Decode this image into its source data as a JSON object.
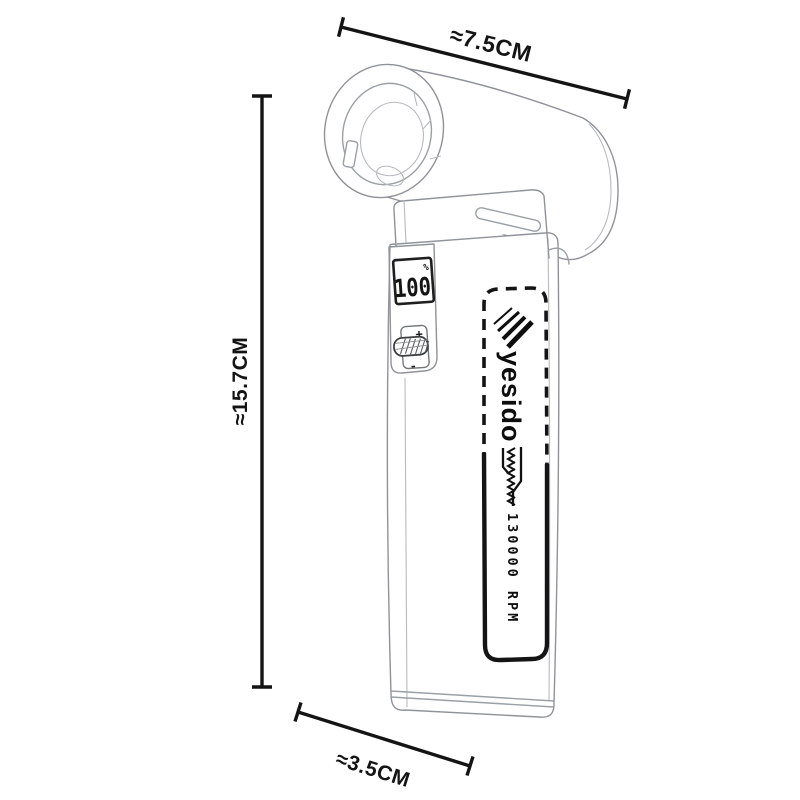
{
  "dimensions": {
    "width": {
      "label": "≈7.5CM"
    },
    "height": {
      "label": "≈15.7CM"
    },
    "depth": {
      "label": "≈3.5CM"
    }
  },
  "fan": {
    "display": {
      "value": "100",
      "unit": "%"
    },
    "controls": {
      "plus": "+",
      "minus": "-"
    },
    "branding": {
      "logo_text": "yesido",
      "speed_text": "130000 RPM"
    }
  },
  "colors": {
    "ink": "#141414",
    "sketch_line": "#9aa0a5",
    "background": "#ffffff"
  }
}
